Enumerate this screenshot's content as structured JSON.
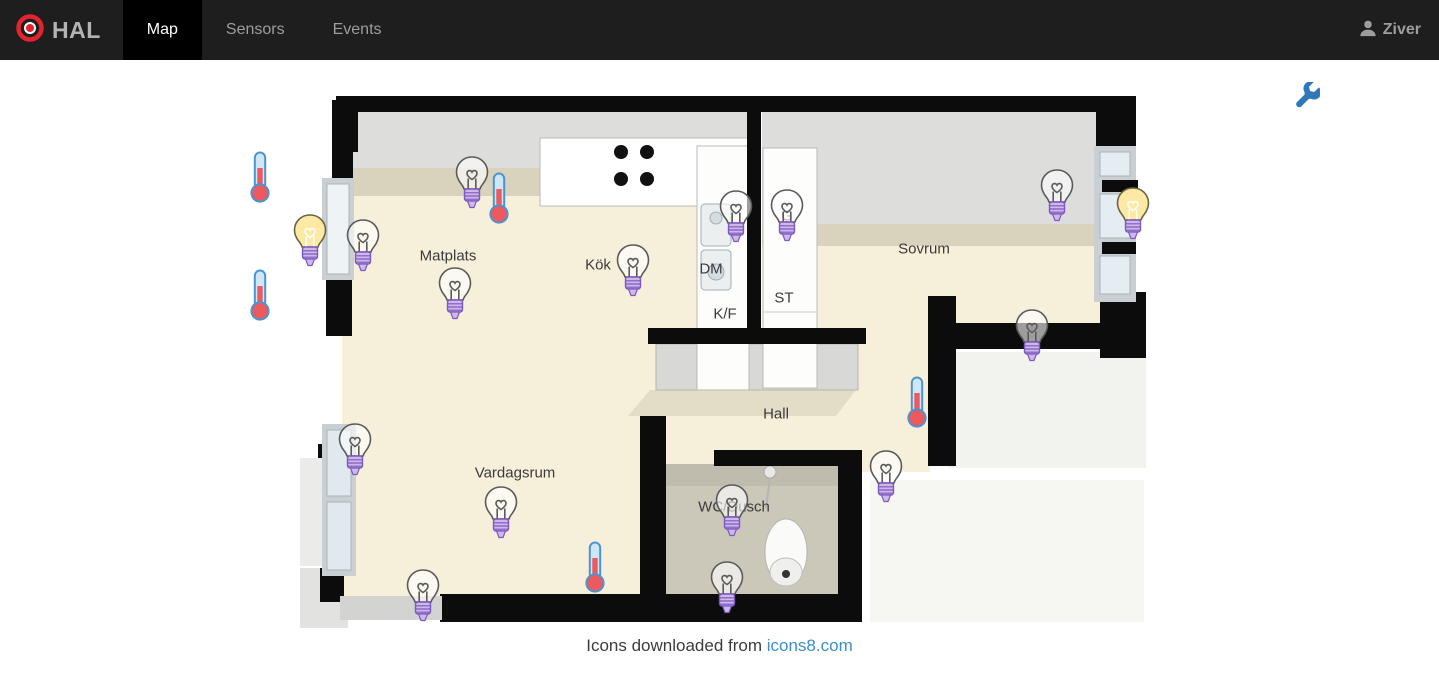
{
  "navbar": {
    "brand": "HAL",
    "tabs": [
      {
        "label": "Map",
        "active": true
      },
      {
        "label": "Sensors",
        "active": false
      },
      {
        "label": "Events",
        "active": false
      }
    ],
    "user": "Ziver"
  },
  "colors": {
    "navbar_bg": "#1e1e1e",
    "active_tab_bg": "#000000",
    "brand_red": "#e4232e",
    "link_blue": "#3d8ec9",
    "wrench_blue": "#3078b8",
    "bulb_on_yellow": "#fce9a4",
    "bulb_base_purple": "#cdb9e7",
    "thermometer_red": "#ec5a5f",
    "floor_beige": "#f6efda",
    "wall_black": "#0c0c0c"
  },
  "map": {
    "rooms": [
      {
        "label": "Matplats",
        "x": 448,
        "y": 256
      },
      {
        "label": "Kök",
        "x": 598,
        "y": 265
      },
      {
        "label": "DM",
        "x": 711,
        "y": 269
      },
      {
        "label": "K/F",
        "x": 725,
        "y": 314
      },
      {
        "label": "G",
        "x": 787,
        "y": 216
      },
      {
        "label": "ST",
        "x": 784,
        "y": 298
      },
      {
        "label": "Sovrum",
        "x": 924,
        "y": 249
      },
      {
        "label": "Hall",
        "x": 776,
        "y": 414
      },
      {
        "label": "Vardagsrum",
        "x": 515,
        "y": 473
      },
      {
        "label": "WC/Dusch",
        "x": 734,
        "y": 507
      }
    ],
    "devices": [
      {
        "type": "thermometer",
        "x": 260,
        "y": 177
      },
      {
        "type": "thermometer",
        "x": 260,
        "y": 295
      },
      {
        "type": "bulb-on",
        "x": 310,
        "y": 241
      },
      {
        "type": "bulb-off",
        "x": 363,
        "y": 246
      },
      {
        "type": "bulb-off",
        "x": 472,
        "y": 183
      },
      {
        "type": "thermometer",
        "x": 499,
        "y": 198
      },
      {
        "type": "bulb-off",
        "x": 455,
        "y": 294
      },
      {
        "type": "bulb-off",
        "x": 633,
        "y": 271
      },
      {
        "type": "bulb-off",
        "x": 736,
        "y": 217
      },
      {
        "type": "bulb-off",
        "x": 787,
        "y": 216
      },
      {
        "type": "bulb-off",
        "x": 1057,
        "y": 196
      },
      {
        "type": "bulb-on",
        "x": 1133,
        "y": 214
      },
      {
        "type": "bulb-off",
        "x": 1032,
        "y": 336
      },
      {
        "type": "thermometer",
        "x": 917,
        "y": 402
      },
      {
        "type": "bulb-off",
        "x": 886,
        "y": 477
      },
      {
        "type": "bulb-off",
        "x": 355,
        "y": 450
      },
      {
        "type": "bulb-off",
        "x": 501,
        "y": 513
      },
      {
        "type": "thermometer",
        "x": 595,
        "y": 567
      },
      {
        "type": "bulb-off",
        "x": 423,
        "y": 596
      },
      {
        "type": "bulb-off",
        "x": 732,
        "y": 511
      },
      {
        "type": "bulb-off",
        "x": 727,
        "y": 588
      }
    ]
  },
  "footer": {
    "text": "Icons downloaded from ",
    "link": "icons8.com"
  }
}
